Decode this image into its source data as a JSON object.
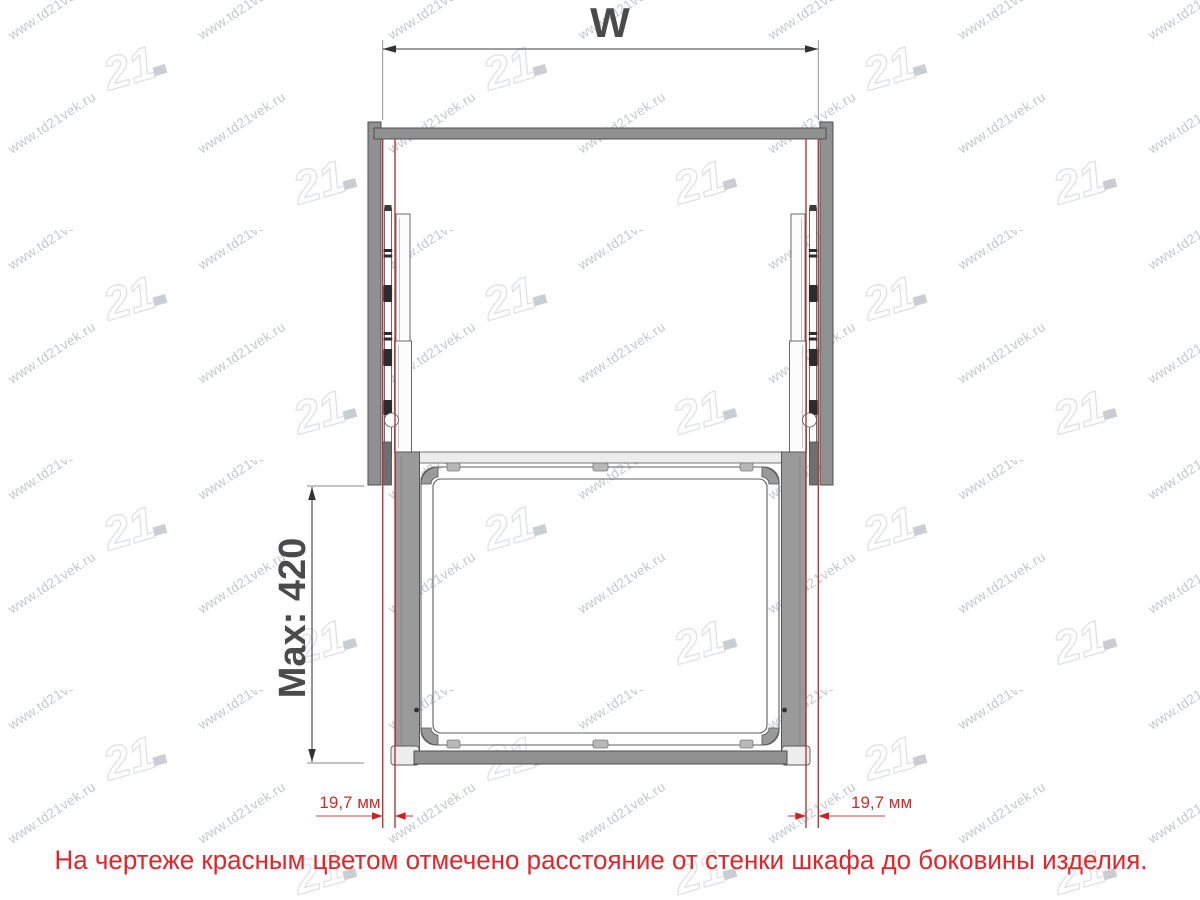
{
  "drawing": {
    "width_dimension_label": "W",
    "height_dimension_label": "Max: 420",
    "left_gap_label": "19,7 мм",
    "right_gap_label": "19,7 мм",
    "annotation_color": "#e3242a",
    "red_marking_color": "#b13a3a",
    "cabinet_gray": "#909090"
  },
  "note": {
    "text": "На чертеже красным цветом отмечено расстояние  от стенки шкафа до боковины изделия."
  },
  "watermark": {
    "url_text": "www.td21vek.ru",
    "logo_text": "21"
  }
}
